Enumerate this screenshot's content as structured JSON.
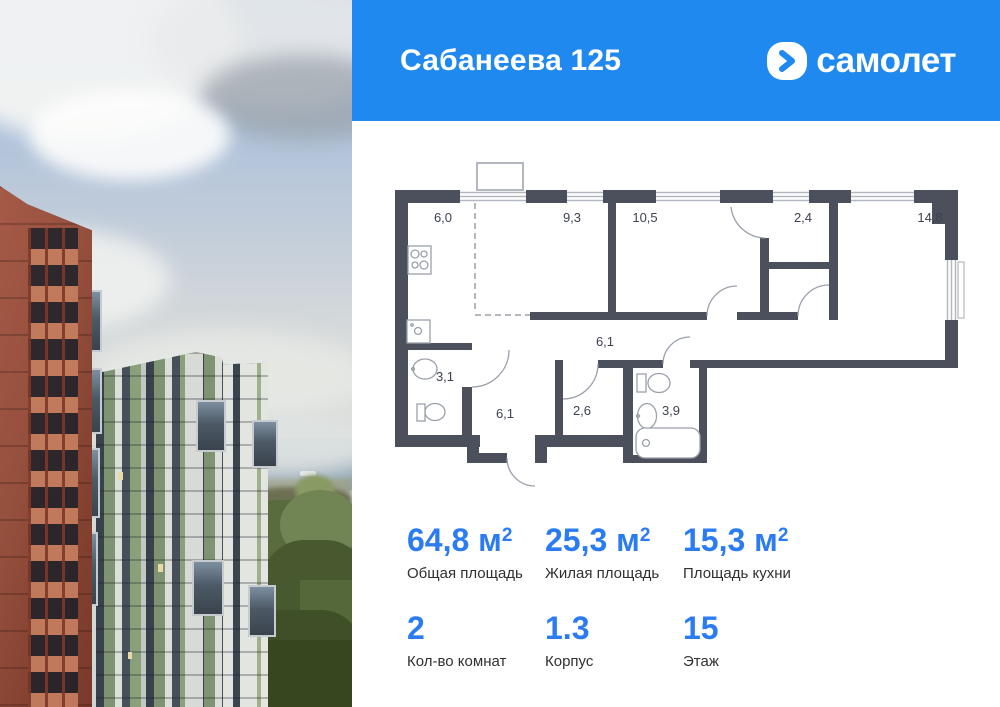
{
  "header": {
    "title": "Сабанеева 125",
    "brand": "самолет"
  },
  "floor_plan": {
    "rooms": [
      {
        "id": "kitchen",
        "area": "6,0"
      },
      {
        "id": "living-room",
        "area": "9,3"
      },
      {
        "id": "bedroom",
        "area": "10,5"
      },
      {
        "id": "wardrobe",
        "area": "2,4"
      },
      {
        "id": "bedroom-2",
        "area": "14,8"
      },
      {
        "id": "corridor",
        "area": "6,1"
      },
      {
        "id": "bathroom-guest",
        "area": "3,1"
      },
      {
        "id": "hallway",
        "area": "6,1"
      },
      {
        "id": "storage",
        "area": "2,6"
      },
      {
        "id": "bathroom",
        "area": "3,9"
      }
    ]
  },
  "stats": {
    "total_area": {
      "value": "64,8",
      "unit": "м",
      "sup": "2",
      "label": "Общая площадь"
    },
    "living_area": {
      "value": "25,3",
      "unit": "м",
      "sup": "2",
      "label": "Жилая площадь"
    },
    "kitchen_area": {
      "value": "15,3",
      "unit": "м",
      "sup": "2",
      "label": "Площадь кухни"
    },
    "rooms_count": {
      "value": "2",
      "label": "Кол-во комнат"
    },
    "building": {
      "value": "1.3",
      "label": "Корпус"
    },
    "floor": {
      "value": "15",
      "label": "Этаж"
    }
  },
  "colors": {
    "brand_blue": "#2089F0",
    "accent_blue": "#2B7BF2",
    "wall": "#4B505C"
  }
}
